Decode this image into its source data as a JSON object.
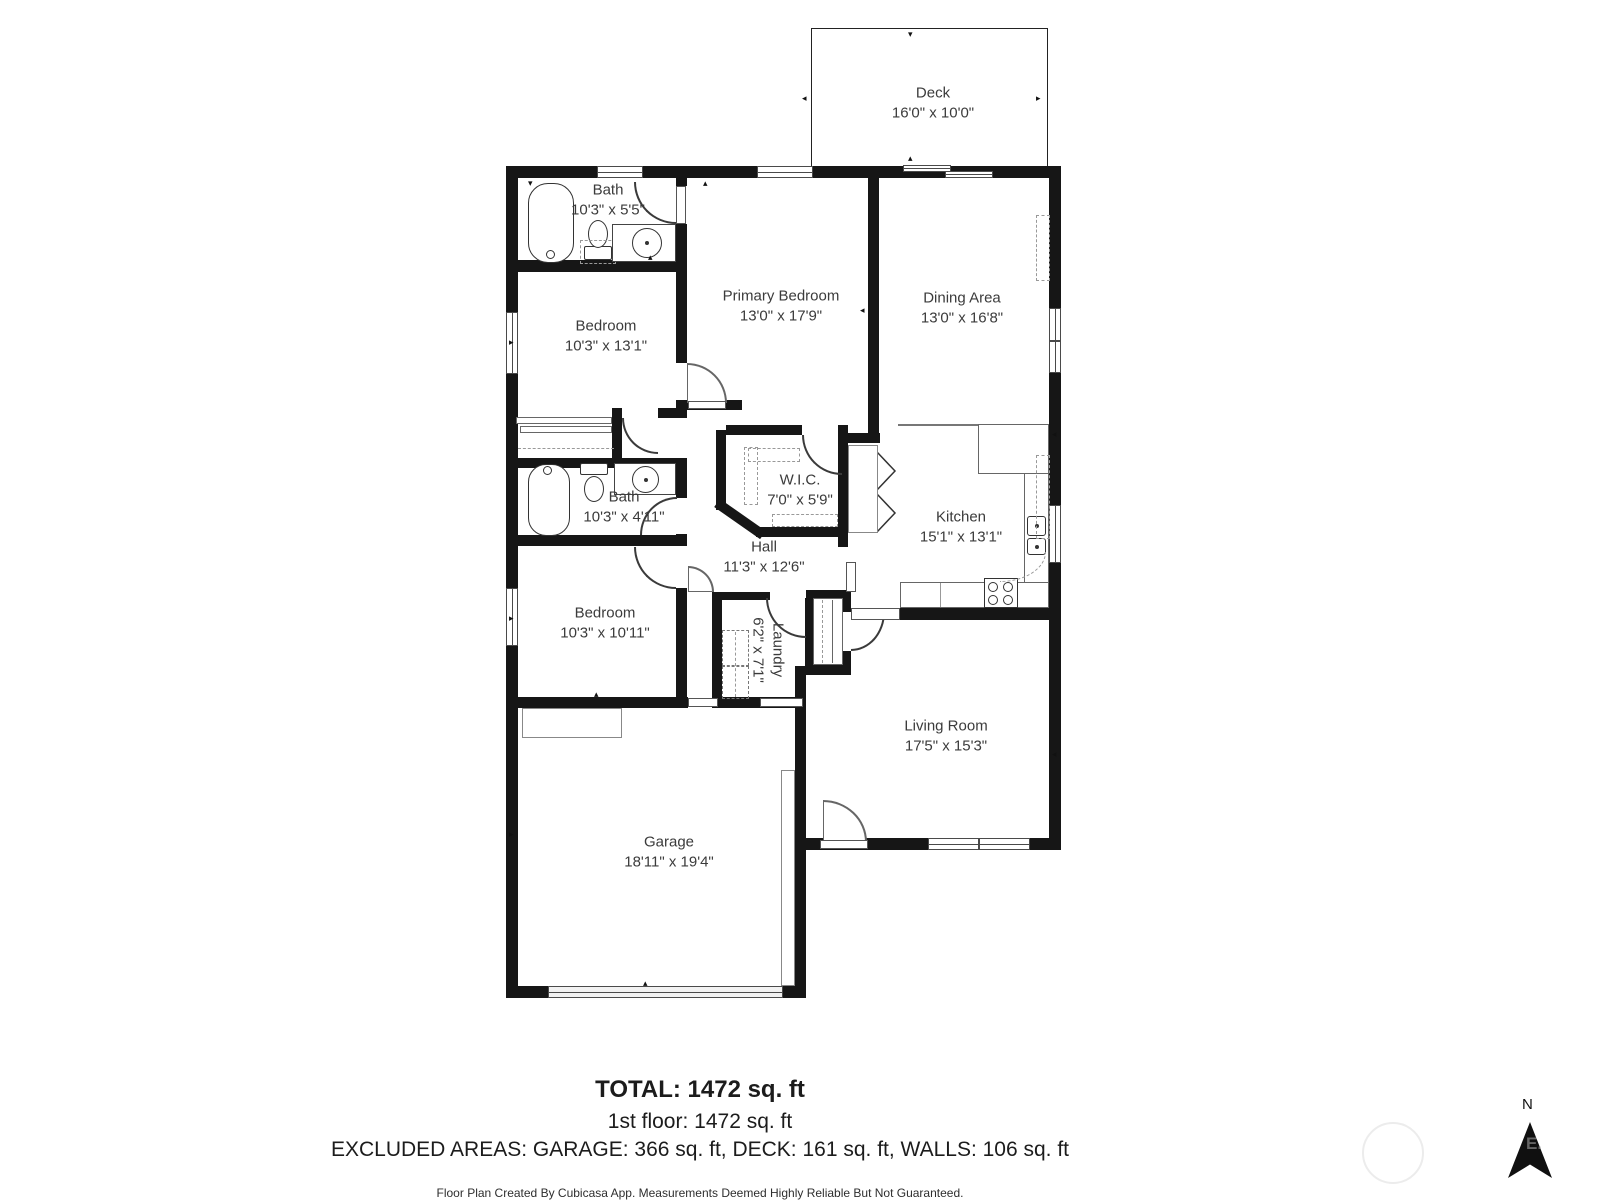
{
  "rooms": {
    "deck": {
      "name": "Deck",
      "dims": "16'0\" x 10'0\""
    },
    "bath_upper": {
      "name": "Bath",
      "dims": "10'3\" x 5'5\""
    },
    "primary": {
      "name": "Primary Bedroom",
      "dims": "13'0\" x 17'9\""
    },
    "dining": {
      "name": "Dining Area",
      "dims": "13'0\" x 16'8\""
    },
    "bedroom_upper": {
      "name": "Bedroom",
      "dims": "10'3\" x 13'1\""
    },
    "wic": {
      "name": "W.I.C.",
      "dims": "7'0\" x 5'9\""
    },
    "bath_lower": {
      "name": "Bath",
      "dims": "10'3\" x 4'11\""
    },
    "kitchen": {
      "name": "Kitchen",
      "dims": "15'1\" x 13'1\""
    },
    "hall": {
      "name": "Hall",
      "dims": "11'3\" x 12'6\""
    },
    "bedroom_lower": {
      "name": "Bedroom",
      "dims": "10'3\" x 10'11\""
    },
    "laundry": {
      "name": "Laundry",
      "dims": "6'2\" x 7'1\""
    },
    "living": {
      "name": "Living Room",
      "dims": "17'5\" x 15'3\""
    },
    "garage": {
      "name": "Garage",
      "dims": "18'11\" x 19'4\""
    }
  },
  "summary": {
    "total": "TOTAL: 1472 sq. ft",
    "floor1": "1st floor: 1472 sq. ft",
    "excluded": "EXCLUDED AREAS: GARAGE: 366 sq. ft, DECK: 161 sq. ft, WALLS: 106 sq. ft",
    "disclaimer": "Floor Plan Created By Cubicasa App. Measurements Deemed Highly Reliable But Not Guaranteed."
  },
  "compass": {
    "north_label": "N",
    "watermark": "E."
  }
}
